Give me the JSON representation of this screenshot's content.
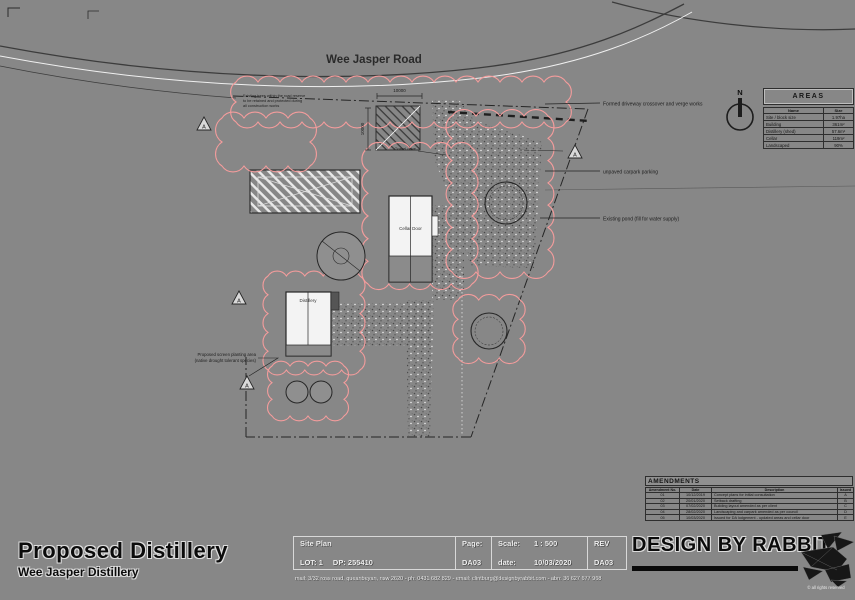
{
  "colors": {
    "background": "#878787",
    "ink": "#2b2b2b",
    "paper": "#f3f3f3",
    "cloud": "#f49c9c"
  },
  "drawing": {
    "road_label": "Wee Jasper Road",
    "north_label": "N",
    "marker_letter": "A",
    "buildings": {
      "cellar_door": "Cellar Door",
      "distillery": "Distillery"
    },
    "dim_width": "10000",
    "dim_depth": "10000",
    "gravel_label": "Gravel drive",
    "road_note": [
      "Existing trees within the road reserve",
      "to be retained and protected during",
      "all construction works"
    ],
    "screen_planting_note": [
      "Proposed screen planting area",
      "(native drought tolerant species)"
    ],
    "callouts": {
      "crossover": "Formed driveway crossover and verge works",
      "parking": "unpaved carpark parking",
      "pond": "Existing pond (fill for water supply)"
    }
  },
  "areas_table": {
    "title": "AREAS",
    "columns": [
      "Name",
      "Size"
    ],
    "rows": [
      [
        "Site / block size",
        "1.97ha"
      ],
      [
        "Building",
        "361m²"
      ],
      [
        "Distillery (shed)",
        "57.6m²"
      ],
      [
        "Cellar",
        "119m²"
      ],
      [
        "Landscaped",
        "90%"
      ]
    ]
  },
  "amendments_table": {
    "title": "AMENDMENTS",
    "columns": [
      "Amendment No.",
      "Date",
      "Description",
      "Issued"
    ],
    "rows": [
      [
        "01",
        "10/12/2019",
        "Concept plans for initial consultation",
        "A"
      ],
      [
        "02",
        "20/01/2020",
        "Setback drafting",
        "B"
      ],
      [
        "03",
        "07/02/2020",
        "Building layout amended as per client",
        "C"
      ],
      [
        "04",
        "28/02/2020",
        "Landscaping and carpark amended as per council",
        "D"
      ],
      [
        "05",
        "10/03/2020",
        "Issued for DA lodgement - updated areas and cellar door",
        "E"
      ]
    ]
  },
  "title_block": {
    "project_title": "Proposed Distillery",
    "project_subtitle": "Wee Jasper Distillery",
    "sheet_name": "Site Plan",
    "lot": "LOT: 1",
    "dp": "DP: 255410",
    "page_label": "Page:",
    "page_value": "DA03",
    "scale_label": "Scale:",
    "scale_value": "1 : 500",
    "date_label": "date:",
    "date_value": "10/03/2020",
    "rev_label": "REV",
    "rev_value": "DA03",
    "brand": "DESIGN BY RABBIT",
    "contact": "mail: 3/32 ross road, queanbeyan, nsw 2620 - ph: 0431 682 829 - email: clintburg@designbyrabbit.com - abn: 36 627 677 968",
    "copyright": "© all rights reserved"
  }
}
